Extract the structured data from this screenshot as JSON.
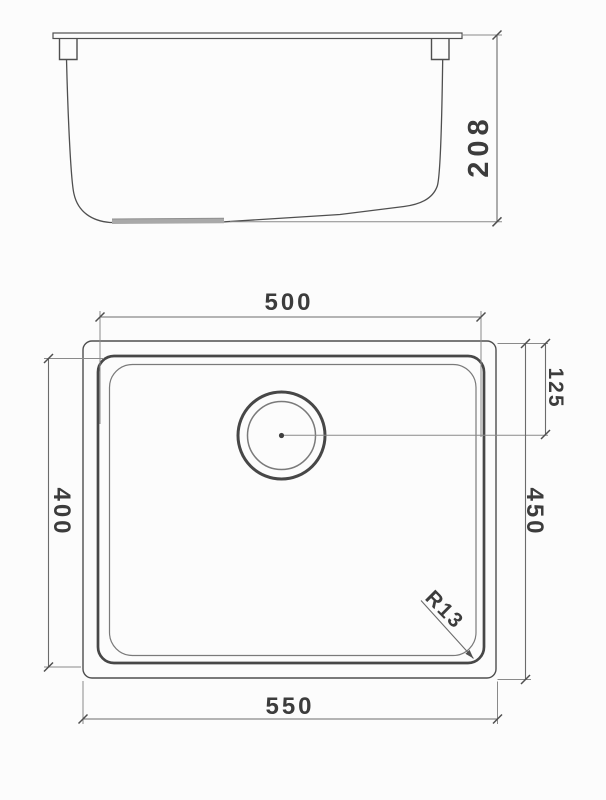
{
  "drawing": {
    "description": "sink technical drawing, side elevation and plan view",
    "background_color": "#fcfcfc",
    "object_line_color": "#4f4f4f",
    "extension_line_color": "#8a8a8a",
    "text_color": "#3c3c3c"
  },
  "side_view": {
    "overall_height": "208"
  },
  "plan_view": {
    "bowl_width_top": "500",
    "overall_width_bottom": "550",
    "bowl_depth_left": "400",
    "overall_depth_right": "450",
    "drain_center_from_top": "125",
    "bowl_corner_radius": "R13"
  }
}
